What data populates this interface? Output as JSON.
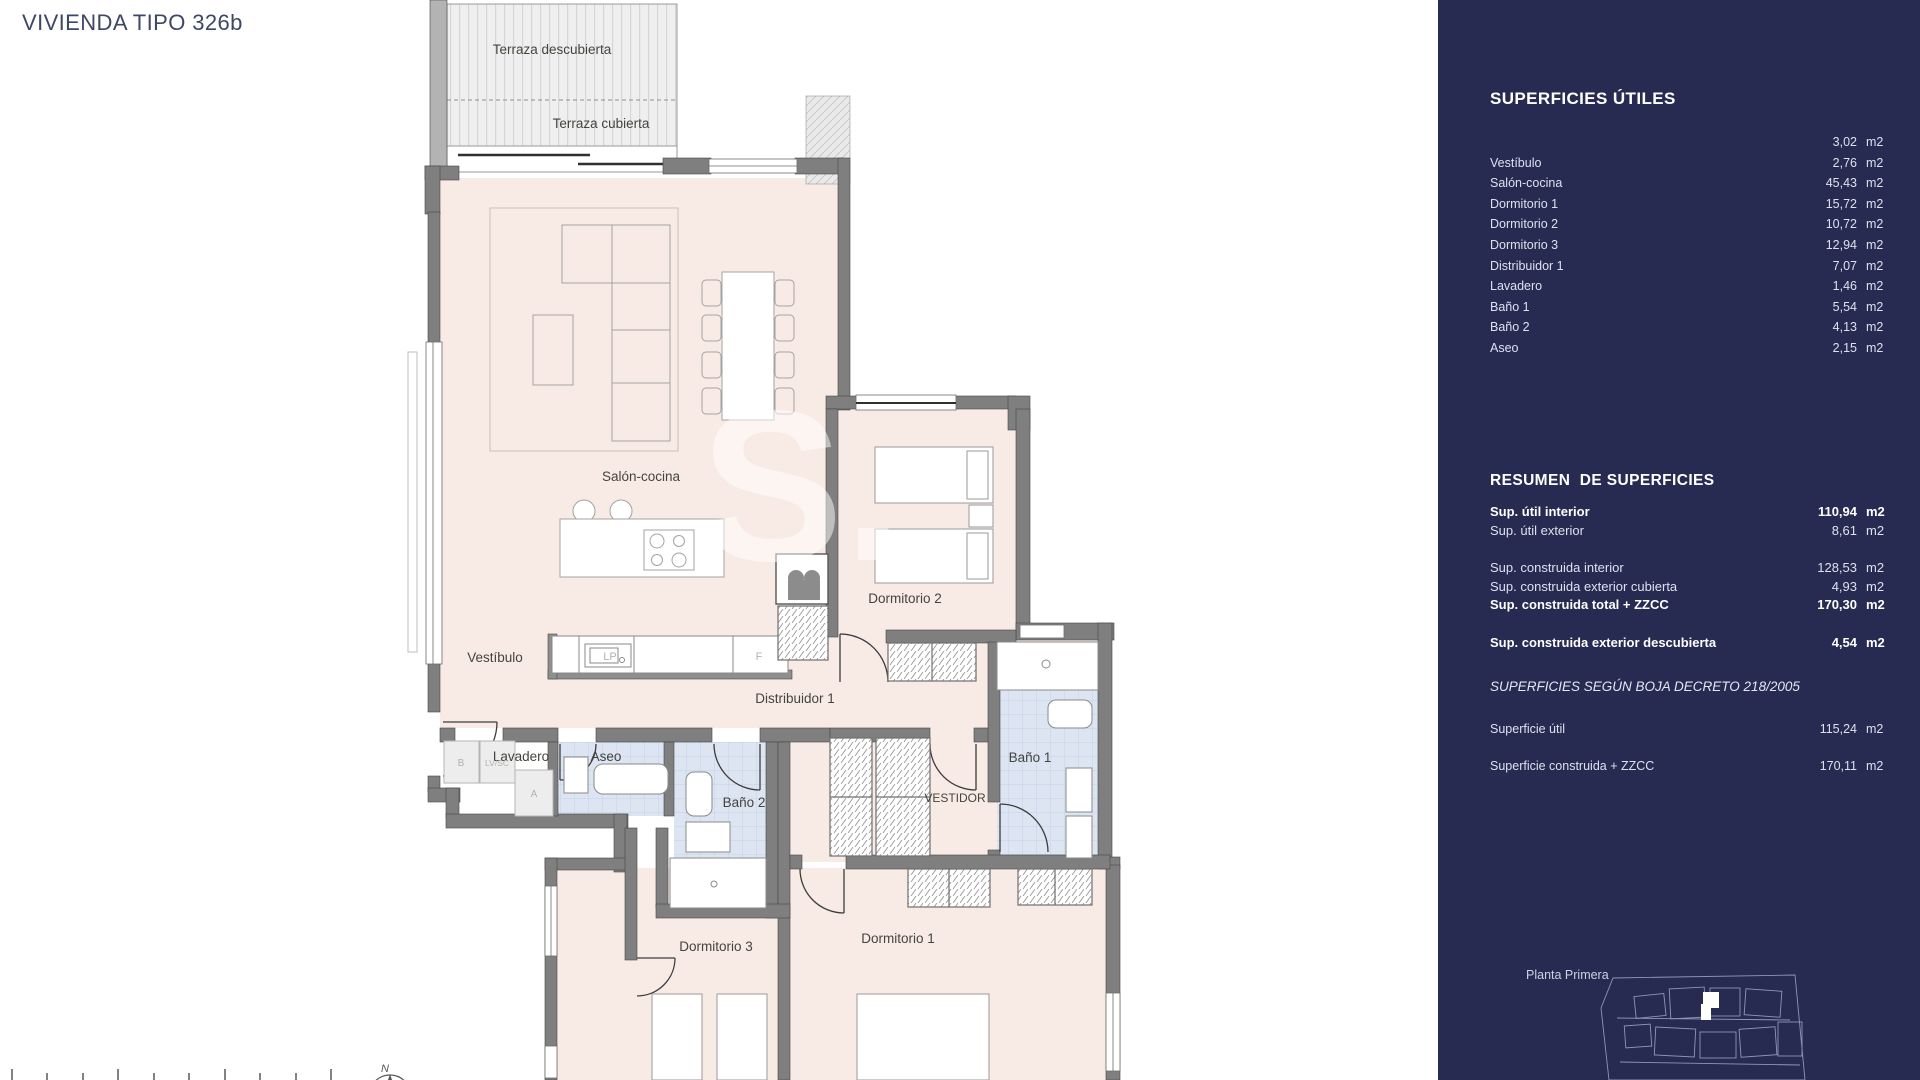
{
  "page": {
    "title": "VIVIENDA TIPO 326b"
  },
  "plan": {
    "rooms": {
      "terraza_descubierta": "Terraza descubierta",
      "terraza_cubierta": "Terraza cubierta",
      "salon": "Salón-cocina",
      "vestibulo": "Vestíbulo",
      "dormitorio2": "Dormitorio 2",
      "distribuidor": "Distribuidor 1",
      "lavadero": "Lavadero",
      "aseo": "Aseo",
      "bano2": "Baño 2",
      "bano1": "Baño 1",
      "vestidor": "VESTIDOR",
      "dormitorio3": "Dormitorio 3",
      "dormitorio1": "Dormitorio 1"
    },
    "appliance_labels": {
      "b": "B",
      "lvsc": "LV/SC",
      "a": "A",
      "lp": "LP",
      "f": "F"
    },
    "north_label": "N",
    "watermark": "S."
  },
  "sidebar": {
    "unit": "m2",
    "superficies_utiles": {
      "title": "SUPERFICIES ÚTILES",
      "rows": [
        {
          "label": "",
          "value": "3,02"
        },
        {
          "label": "Vestíbulo",
          "value": "2,76"
        },
        {
          "label": "Salón-cocina",
          "value": "45,43"
        },
        {
          "label": "Dormitorio 1",
          "value": "15,72"
        },
        {
          "label": "Dormitorio 2",
          "value": "10,72"
        },
        {
          "label": "Dormitorio 3",
          "value": "12,94"
        },
        {
          "label": "Distribuidor 1",
          "value": "7,07"
        },
        {
          "label": "Lavadero",
          "value": "1,46"
        },
        {
          "label": "Baño 1",
          "value": "5,54"
        },
        {
          "label": "Baño 2",
          "value": "4,13"
        },
        {
          "label": "Aseo",
          "value": "2,15"
        }
      ]
    },
    "resumen": {
      "title": "RESUMEN  DE SUPERFICIES",
      "rows": [
        {
          "label": "Sup. útil interior",
          "value": "110,94"
        },
        {
          "label": "Sup. útil exterior",
          "value": "8,61"
        },
        {
          "label": "Sup. construida interior",
          "value": "128,53"
        },
        {
          "label": "Sup. construida exterior cubierta",
          "value": "4,93"
        },
        {
          "label": "Sup. construida total + ZZCC",
          "value": "170,30"
        },
        {
          "label": "Sup. construida exterior descubierta",
          "value": "4,54"
        }
      ]
    },
    "boja": {
      "title": "SUPERFICIES SEGÚN BOJA DECRETO 218/2005",
      "rows": [
        {
          "label": "Superficie útil",
          "value": "115,24"
        },
        {
          "label": "Superficie construida + ZZCC",
          "value": "170,11"
        }
      ]
    },
    "planta_label": "Planta Primera"
  }
}
